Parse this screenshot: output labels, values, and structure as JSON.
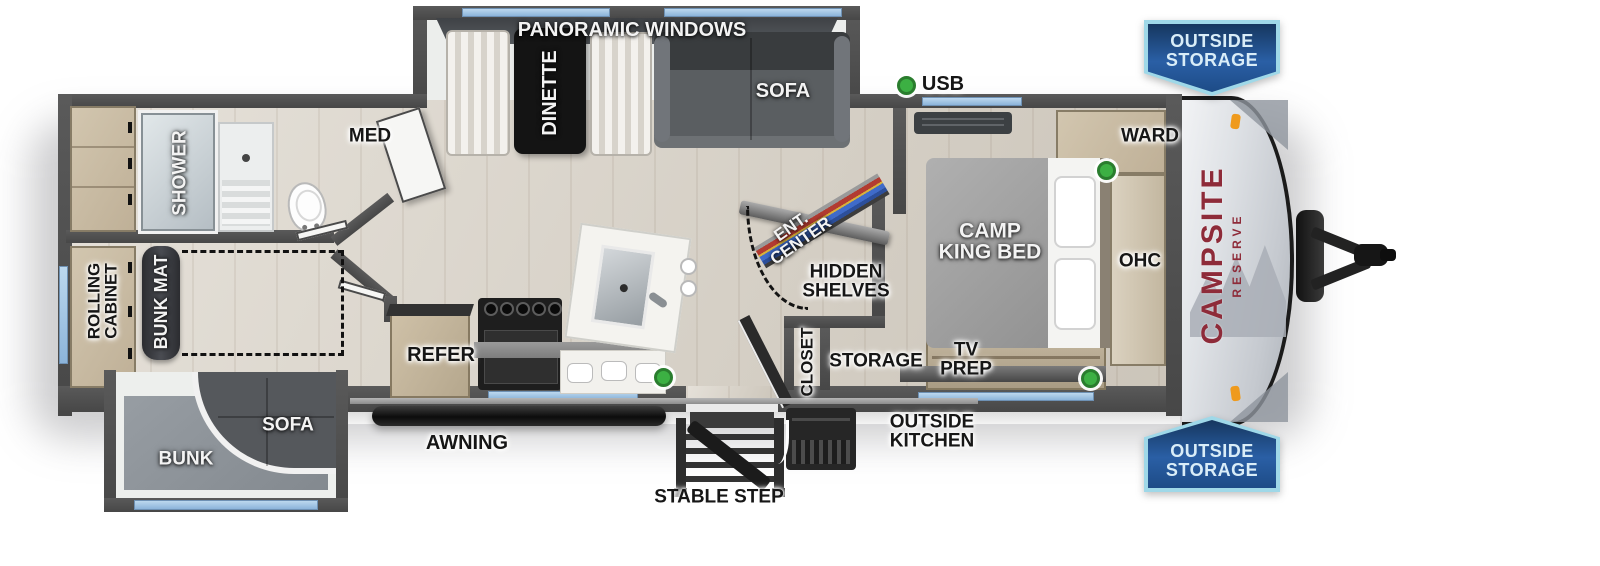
{
  "page": {
    "description": "Top-view RV travel trailer floorplan, Campsite Reserve"
  },
  "brand": {
    "line1": "CAMPSITE",
    "line2": "RESERVE",
    "color": "#8e2b39"
  },
  "badges": {
    "top": {
      "line1": "OUTSIDE",
      "line2": "STORAGE"
    },
    "bottom": {
      "line1": "OUTSIDE",
      "line2": "STORAGE"
    }
  },
  "labels": {
    "panoramic_windows": "PANORAMIC WINDOWS",
    "dinette": "DINETTE",
    "sofa_slide": "SOFA",
    "usb": "USB",
    "med": "MED",
    "ward": "WARD",
    "shower": "SHOWER",
    "camp_king_bed_1": "CAMP",
    "camp_king_bed_2": "KING BED",
    "ohc": "OHC",
    "ent_center_1": "ENT.",
    "ent_center_2": "CENTER",
    "hidden_shelves_1": "HIDDEN",
    "hidden_shelves_2": "SHELVES",
    "rolling_cabinet_1": "ROLLING",
    "rolling_cabinet_2": "CABINET",
    "bunk_mat": "BUNK MAT",
    "closet": "CLOSET",
    "storage": "STORAGE",
    "tv_prep_1": "TV",
    "tv_prep_2": "PREP",
    "outside_kitchen_1": "OUTSIDE",
    "outside_kitchen_2": "KITCHEN",
    "refer": "REFER",
    "sofa_bunk": "SOFA",
    "bunk": "BUNK",
    "awning": "AWNING",
    "stable_step": "STABLE STEP"
  },
  "colors": {
    "wall": "#4f4f4f",
    "window_blue": "#9ec3e4",
    "banner_blue": "#2a5fa5",
    "banner_border": "#9fd8e8",
    "usb_green": "#3cb043",
    "brand_red": "#8e2b39"
  }
}
